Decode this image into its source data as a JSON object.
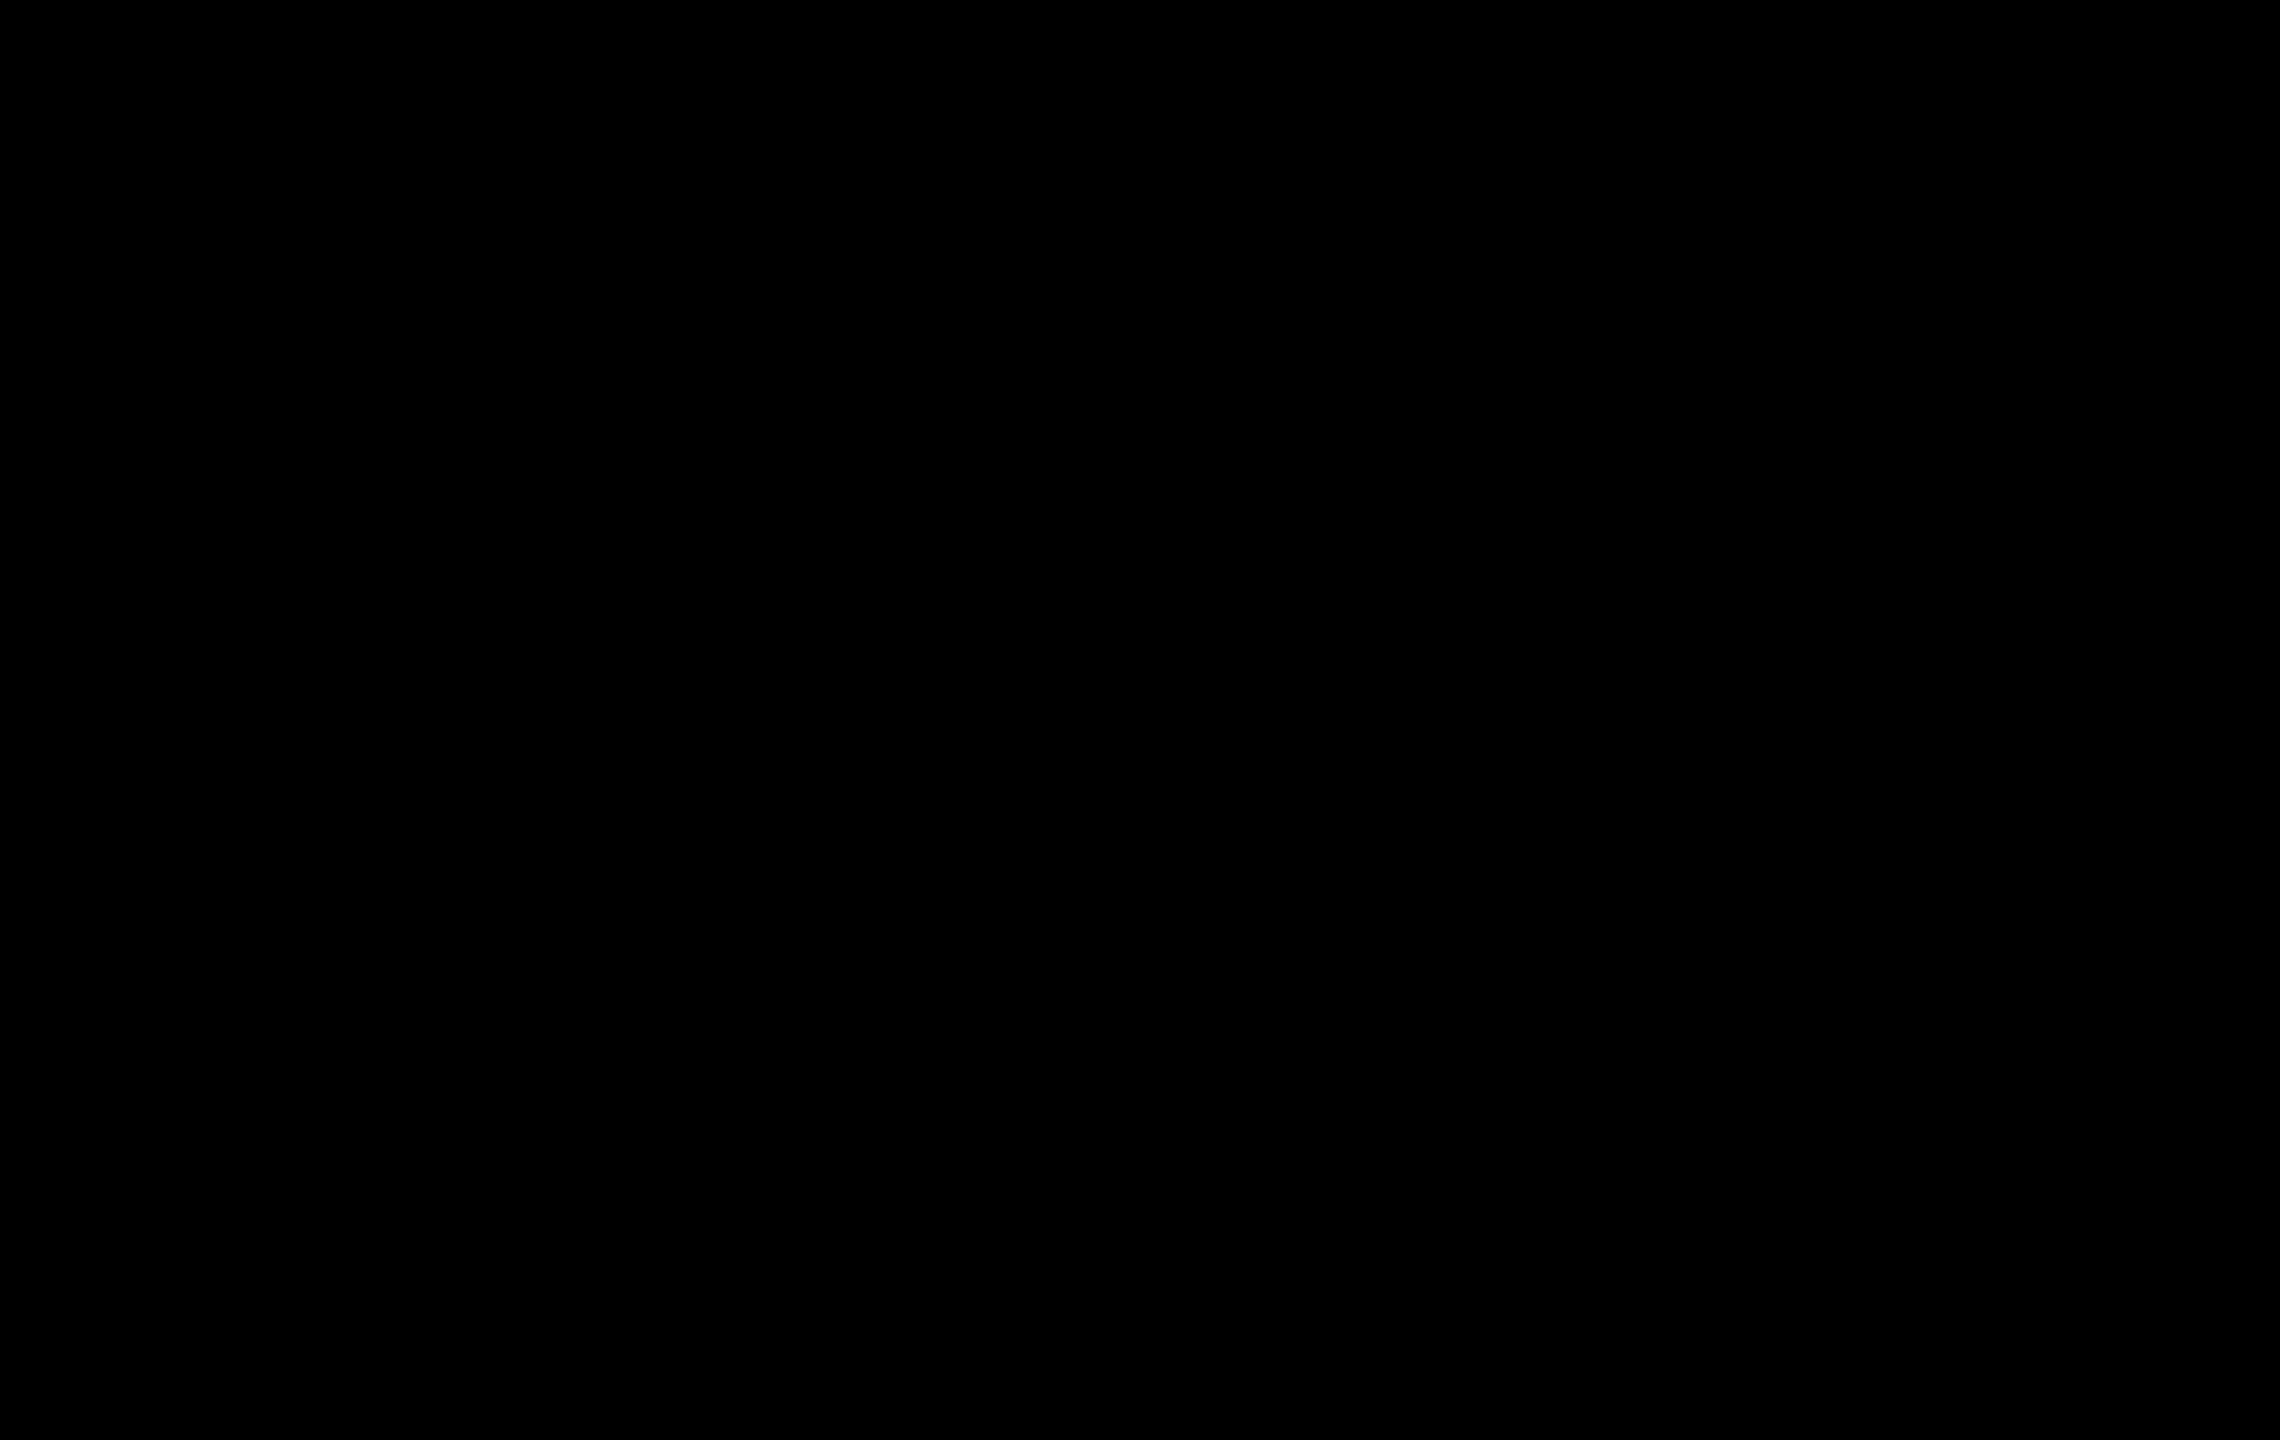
{
  "map": {
    "width": 2280,
    "height": 1440,
    "tile": 40,
    "background": "#000000",
    "kind": "tagpro-style-ctf-level"
  },
  "colors": {
    "floor": "#e9e8eb",
    "floor_line": "#dbdade",
    "floor_hi": "#f6f5f8",
    "wall": "#47474b",
    "wall_edge": "#1b1b1e",
    "void": "#000000",
    "peach": "#f1ccb8",
    "peach_line": "#e0b9a4",
    "peach_hi": "#f8dccd",
    "blue": "#c8dbeb",
    "blue_line": "#b5cadd",
    "blue_hi": "#daeaf5",
    "yellow": "#f0eecb",
    "yellow_line": "#dfddb4",
    "yellow_hi": "#f7f5dc",
    "checker_white": "#ededf0",
    "speck_base": "#929196",
    "speck_dot": "#5c5c60",
    "speck_dark": "#77767b",
    "speck_hi": "#a9a8ad",
    "cell_bg": "#f3f2f5",
    "cell_line": "#b9b8bf",
    "gate_blue_a": "#74b3d4",
    "gate_blue_b": "#54b07e",
    "gate_red_a": "#f35a40",
    "gate_red_b": "#ee7c34",
    "spike": "#0c0c0e",
    "bomb_hi": "#f7f3f6",
    "bomb_mid": "#a85f93",
    "bomb_dark": "#7d3a58",
    "bomb_spark": "#f5a02d",
    "powerup_a": "#6fbf3f",
    "powerup_b": "#d6dc40",
    "orb_a": "#9ecd3a",
    "orb_b": "#e4ec55",
    "button_a": "#ffe070",
    "button_b": "#eda11c",
    "ghost": "#c4d0ae",
    "boost_yellow": "#f1ac2c",
    "boost_yellow_edge": "#c07d12",
    "boost_teal": "#45bfa9",
    "boost_teal_edge": "#239a88",
    "boost_orange": "#f1703c",
    "boost_orange_edge": "#c44c1d",
    "flag_fill": "#ffe23c",
    "flag_fold": "#f2a22c",
    "flag_pole": "#2a2a2e"
  },
  "objects": {
    "flag": {
      "x": 1126,
      "y": 282,
      "kind": "yellow-flag"
    },
    "spikes": [
      [
        739,
        660
      ],
      [
        779,
        660
      ],
      [
        1501,
        660
      ],
      [
        1541,
        660
      ],
      [
        97,
        820
      ],
      [
        97,
        860
      ],
      [
        2183,
        820
      ],
      [
        2183,
        860
      ],
      [
        60,
        1380
      ],
      [
        2220,
        1380
      ]
    ],
    "bombs": [
      [
        66,
        860
      ],
      [
        2214,
        860
      ],
      [
        1140,
        542
      ]
    ],
    "powerups": [
      [
        1142,
        420
      ]
    ],
    "orbs": [
      [
        220,
        860
      ],
      [
        2060,
        860
      ]
    ],
    "boosts": [
      {
        "x": 980,
        "y": 538,
        "c": "yellow"
      },
      {
        "x": 1300,
        "y": 538,
        "c": "yellow"
      },
      {
        "x": 262,
        "y": 739,
        "c": "yellow"
      },
      {
        "x": 2018,
        "y": 739,
        "c": "yellow"
      },
      {
        "x": 978,
        "y": 1138,
        "c": "yellow"
      },
      {
        "x": 1302,
        "y": 1138,
        "c": "yellow"
      },
      {
        "x": 303,
        "y": 1316,
        "c": "yellow"
      },
      {
        "x": 1977,
        "y": 1316,
        "c": "yellow"
      },
      {
        "x": 140,
        "y": 1380,
        "c": "teal"
      },
      {
        "x": 2140,
        "y": 1380,
        "c": "orange"
      }
    ],
    "buttons": [
      [
        459,
        899
      ],
      [
        1821,
        899
      ]
    ],
    "ghosts": [
      [
        940,
        1020
      ],
      [
        1340,
        1020
      ]
    ]
  },
  "tiles": {
    "peach": [
      [
        600,
        880,
        40,
        364
      ],
      [
        640,
        928,
        40,
        316
      ],
      [
        680,
        960,
        35,
        284
      ],
      [
        795,
        960,
        40,
        284
      ],
      [
        400,
        720,
        40,
        40
      ],
      [
        440,
        760,
        40,
        40
      ],
      [
        480,
        800,
        40,
        40
      ],
      [
        1800,
        720,
        40,
        40
      ],
      [
        1840,
        760,
        40,
        40
      ],
      [
        1760,
        760,
        40,
        40
      ],
      [
        1800,
        800,
        40,
        40
      ],
      [
        1720,
        800,
        40,
        40
      ],
      [
        2000,
        1200,
        40,
        40
      ]
    ],
    "blue": [
      [
        1445,
        960,
        40,
        284
      ],
      [
        1565,
        960,
        35,
        284
      ],
      [
        1600,
        928,
        40,
        316
      ],
      [
        1640,
        880,
        40,
        364
      ],
      [
        440,
        720,
        40,
        40
      ],
      [
        400,
        760,
        40,
        40
      ],
      [
        480,
        760,
        40,
        40
      ],
      [
        440,
        800,
        40,
        40
      ],
      [
        520,
        800,
        40,
        40
      ],
      [
        1840,
        720,
        40,
        40
      ],
      [
        1800,
        760,
        40,
        40
      ],
      [
        1760,
        800,
        40,
        40
      ],
      [
        240,
        840,
        40,
        40
      ],
      [
        2000,
        840,
        40,
        40
      ],
      [
        240,
        1200,
        40,
        40
      ]
    ],
    "yellow": [
      [
        638,
        1320,
        240,
        80
      ],
      [
        1402,
        1320,
        240,
        80
      ],
      [
        1040,
        1120,
        40,
        40
      ],
      [
        1080,
        1080,
        40,
        40
      ],
      [
        1120,
        1120,
        40,
        40
      ],
      [
        1160,
        1080,
        40,
        40
      ],
      [
        1200,
        1120,
        40,
        40
      ]
    ],
    "white_cells": [
      [
        1040,
        1080,
        40,
        40
      ],
      [
        1080,
        1120,
        40,
        40
      ],
      [
        1120,
        1080,
        40,
        40
      ],
      [
        1160,
        1120,
        40,
        40
      ],
      [
        1200,
        1080,
        40,
        40
      ]
    ],
    "checker_blue": [
      [
        715,
        960,
        80,
        284
      ]
    ],
    "checker_peach": [
      [
        1485,
        960,
        80,
        284
      ]
    ],
    "speckled": [
      [
        440,
        840,
        200,
        40
      ],
      [
        1640,
        840,
        200,
        40
      ]
    ]
  },
  "walls": {
    "top_band": [
      696,
      12,
      888,
      34
    ],
    "bottom_band": [
      16,
      1398,
      2248,
      38
    ],
    "left_vert": [
      18,
      796,
      34,
      640
    ],
    "right_vert": [
      2228,
      796,
      34,
      640
    ],
    "diag_left": [
      704,
      26,
      62,
      810
    ],
    "diag_right": [
      1576,
      26,
      2218,
      810
    ],
    "trap_outer": [
      [
        445,
        678
      ],
      [
        1835,
        678
      ],
      [
        1560,
        962
      ],
      [
        720,
        962
      ]
    ],
    "void": [
      [
        505,
        714
      ],
      [
        1775,
        714
      ],
      [
        1565,
        918
      ],
      [
        715,
        918
      ]
    ],
    "wedges": [
      [
        [
          952,
          280
        ],
        [
          992,
          280
        ],
        [
          952,
          320
        ]
      ],
      [
        [
          1288,
          280
        ],
        [
          1328,
          280
        ],
        [
          1328,
          320
        ]
      ],
      [
        [
          1078,
          520
        ],
        [
          1118,
          520
        ],
        [
          1078,
          560
        ]
      ],
      [
        [
          1162,
          520
        ],
        [
          1202,
          520
        ],
        [
          1202,
          560
        ]
      ]
    ],
    "ledges": [
      [
        [
          225,
          812
        ],
        [
          396,
          812
        ],
        [
          434,
          840
        ],
        [
          225,
          840
        ]
      ],
      [
        [
          2055,
          812
        ],
        [
          1884,
          812
        ],
        [
          1846,
          840
        ],
        [
          2055,
          840
        ]
      ]
    ],
    "hooks": [
      [
        [
          840,
          960
        ],
        [
          876,
          960
        ],
        [
          876,
          1022
        ],
        [
          936,
          1078
        ],
        [
          914,
          1100
        ],
        [
          840,
          1034
        ]
      ],
      [
        [
          1440,
          960
        ],
        [
          1404,
          960
        ],
        [
          1404,
          1022
        ],
        [
          1344,
          1078
        ],
        [
          1366,
          1100
        ],
        [
          1440,
          1034
        ]
      ]
    ],
    "funnel_rects": [
      [
        1038,
        955,
        36,
        121
      ],
      [
        1206,
        955,
        36,
        121
      ]
    ],
    "funnel_lines": [
      [
        1054,
        1068,
        1090,
        1108
      ],
      [
        1226,
        1068,
        1190,
        1108
      ]
    ],
    "bridge": [
      1040,
      955,
      200,
      32
    ],
    "column": [
      1048,
      1158,
      184,
      274
    ],
    "pedestals": [
      [
        [
          640,
          1320
        ],
        [
          688,
          1244
        ],
        [
          846,
          1244
        ],
        [
          878,
          1320
        ]
      ],
      [
        [
          1402,
          1320
        ],
        [
          1434,
          1244
        ],
        [
          1592,
          1244
        ],
        [
          1640,
          1320
        ]
      ]
    ],
    "ramps": [
      [
        306,
        1324,
        440,
        1398
      ],
      [
        516,
        1324,
        477,
        1398
      ],
      [
        1974,
        1324,
        1840,
        1398
      ],
      [
        1764,
        1324,
        1803,
        1398
      ]
    ],
    "slit": [
      1062,
      1386,
      9,
      34
    ],
    "stair": {
      "top_left_x": 700,
      "top_right_x": 1580,
      "top_y": 14,
      "step_w": 40,
      "step_h": 47,
      "steps": 16,
      "side_x_left": 40,
      "side_x_right": 2240,
      "bottom_y": 1436
    }
  },
  "structures": {
    "gate_towers": [
      {
        "x": 704,
        "y": 866,
        "team": "blue"
      },
      {
        "x": 1474,
        "y": 866,
        "team": "red"
      }
    ],
    "mini_towers": [
      {
        "x": 1072,
        "y": 982
      },
      {
        "x": 1154,
        "y": 982
      }
    ]
  }
}
